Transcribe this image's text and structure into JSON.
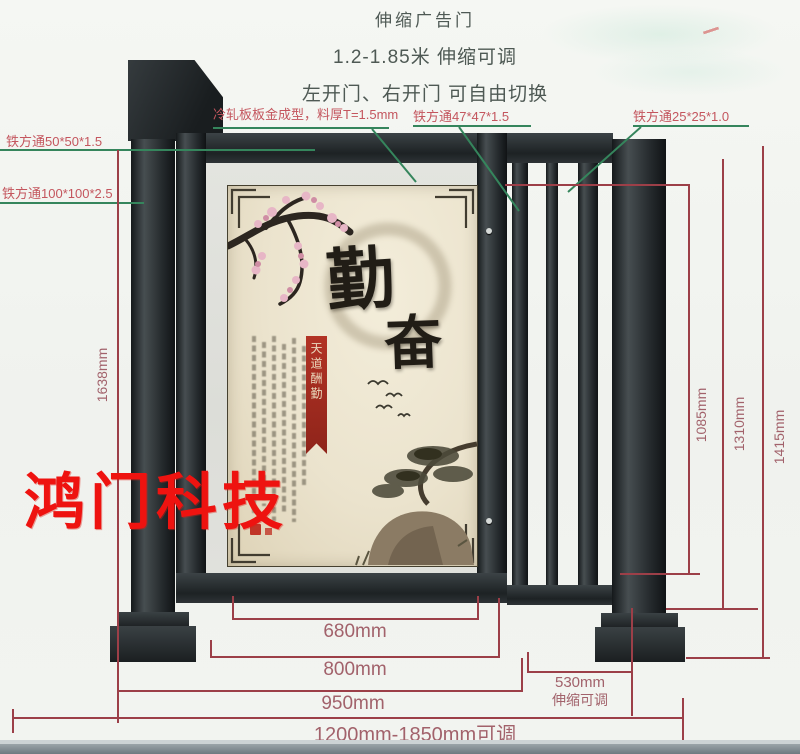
{
  "header": {
    "line1": "伸缩广告门",
    "line2": "1.2-1.85米 伸缩可调",
    "line3": "左开门、右开门 可自由切换"
  },
  "watermark": {
    "text": "鸿门科技"
  },
  "callouts": {
    "tube50": "铁方通50*50*1.5",
    "tube100": "铁方通100*100*2.5",
    "panel": "冷轧板板金成型，料厚T=1.5mm",
    "tube47": "铁方通47*47*1.5",
    "tube25": "铁方通25*25*1.0"
  },
  "dimensions": {
    "height_left": "1638mm",
    "height_inner": "1085mm",
    "height_mid": "1310mm",
    "height_right": "1415mm",
    "width_poster": "680mm",
    "width_door": "800mm",
    "width_frame": "950mm",
    "width_telescopic": "530mm",
    "telescopic_note": "伸缩可调",
    "width_total": "1200mm-1850mm可调"
  },
  "poster": {
    "char_top": "勤",
    "char_bottom": "奋",
    "banner": "天道酬勤"
  },
  "colors": {
    "steel": "#2a2f32",
    "dimension_line": "#9c3f48",
    "dimension_text": "#a2626b",
    "callout_line": "#35855c",
    "callout_text": "#c4565e",
    "watermark_red": "#ee1310",
    "poster_cream": "#ece5d2"
  }
}
